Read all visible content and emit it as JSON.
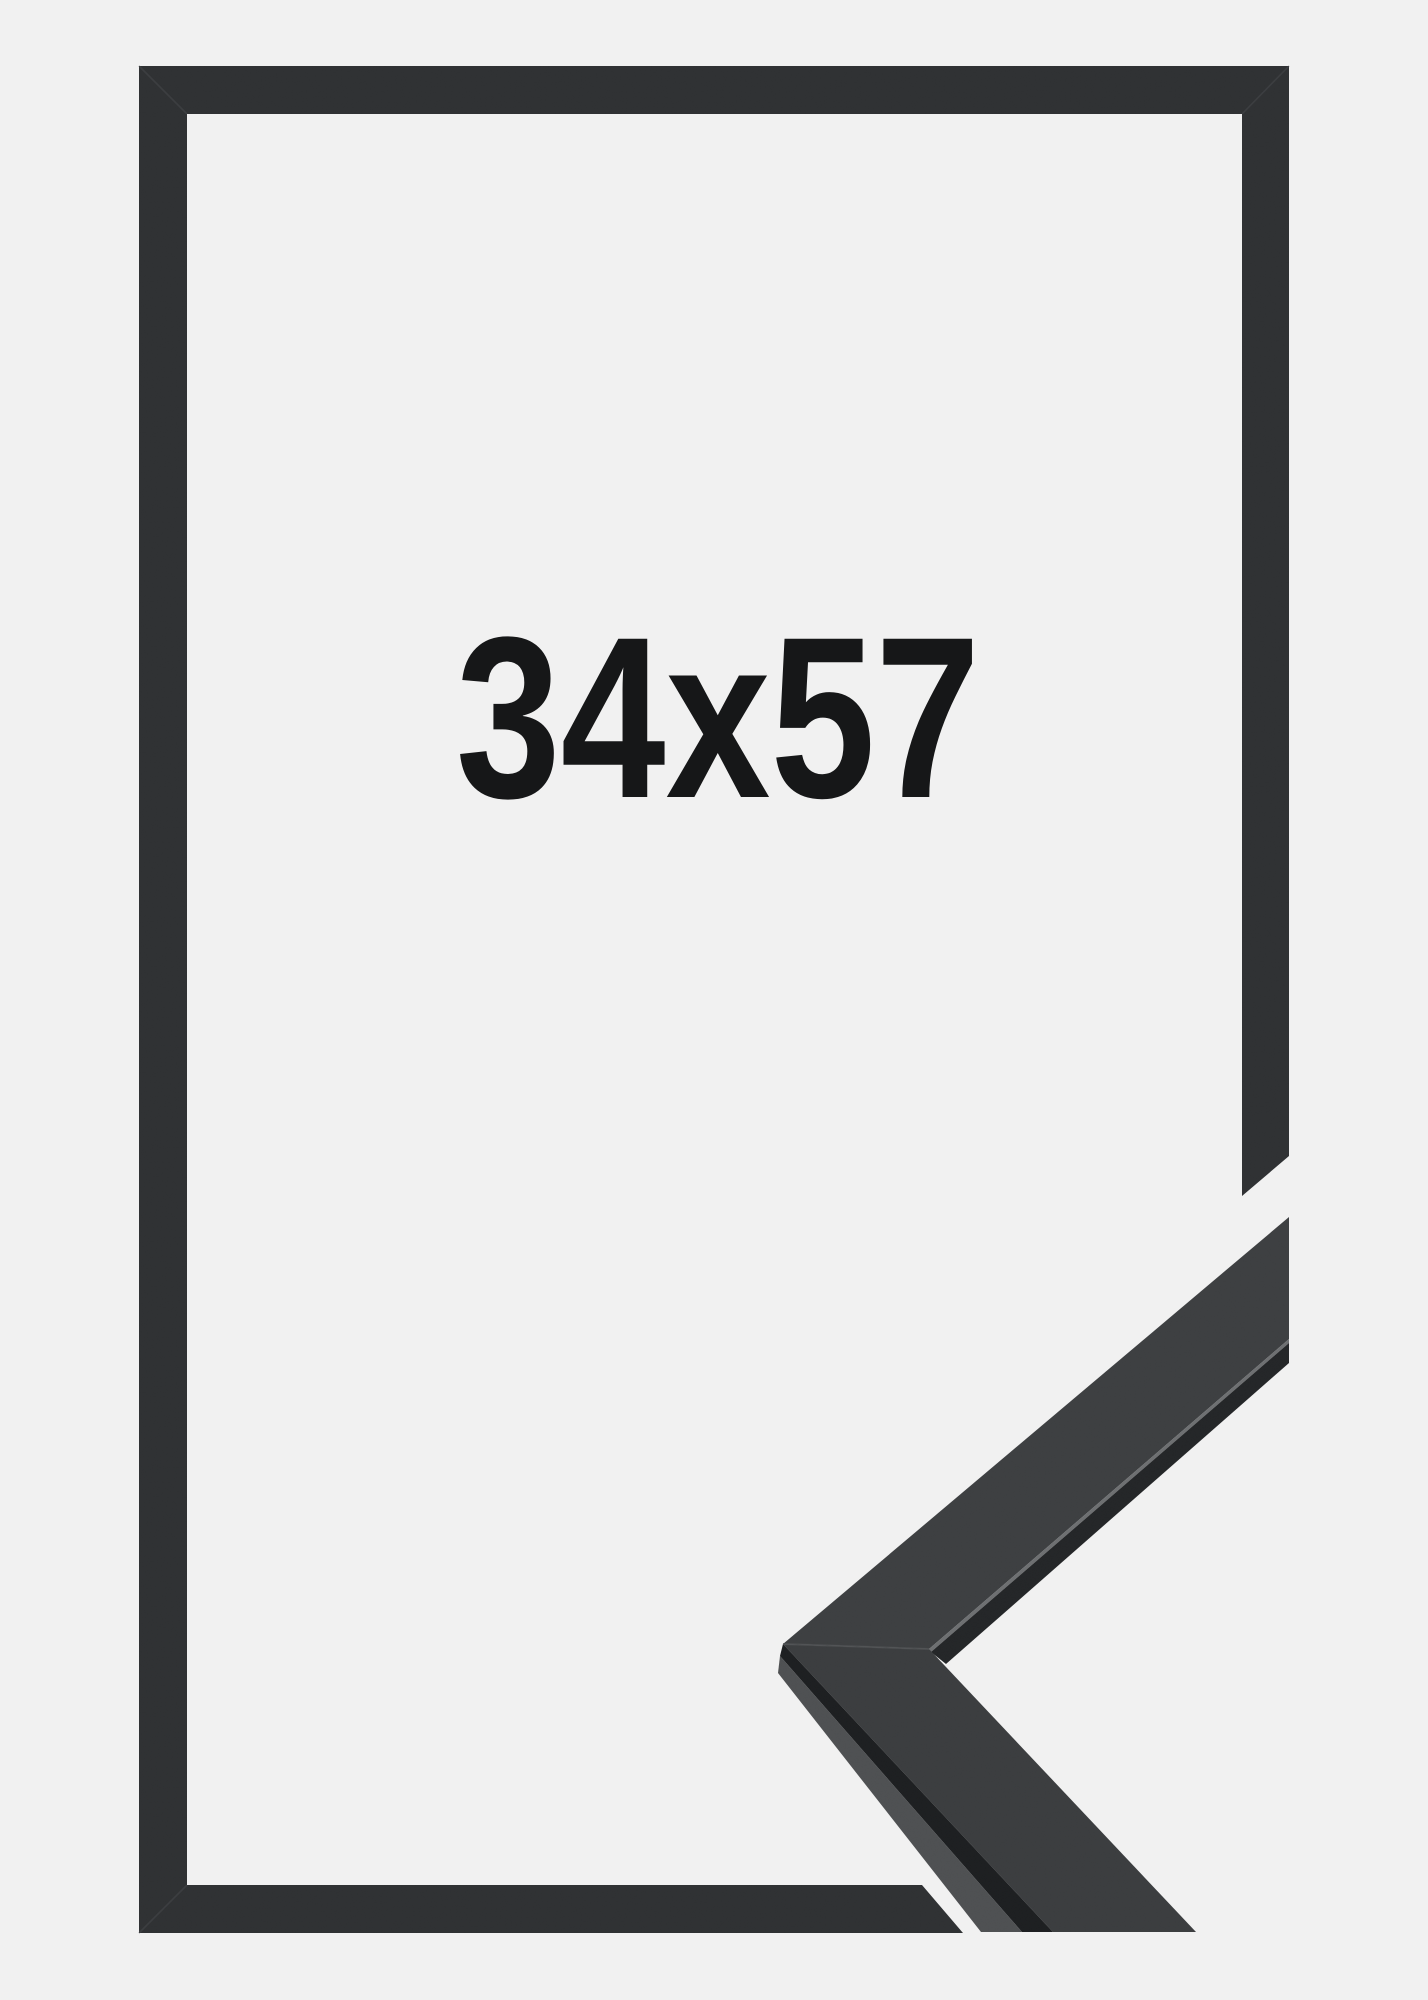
{
  "product_image": {
    "size_label": "34x57"
  },
  "colors": {
    "background": "#f1f1f1",
    "label_text": "#161718",
    "frame": "#2f3133",
    "frame_seam": "#46484b",
    "piece_upper_face": "#3d3f41",
    "piece_lower_face": "#3b3d3f",
    "piece_side_face": "#4e5052",
    "piece_arris_dark": "#1d1f21",
    "piece_inner_wall": "#242628",
    "piece_edge_highlight": "#6d6f71",
    "piece_miter_seam": "#525456"
  }
}
